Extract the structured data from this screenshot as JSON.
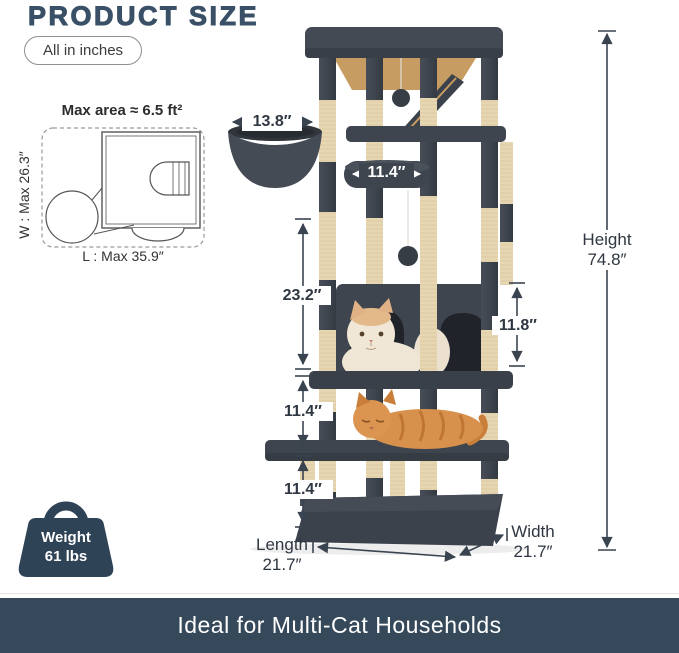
{
  "header": {
    "title": "PRODUCT SIZE",
    "unit_note": "All in inches"
  },
  "footprint": {
    "title": "Max area ≈ 6.5 ft²",
    "width_label": "W : Max 26.3″",
    "length_label": "L : Max 35.9″"
  },
  "dims": {
    "basket_width": "13.8″",
    "perch_width": "11.4″",
    "upper_height": "23.2″",
    "condo_height": "11.8″",
    "mid_height": "11.4″",
    "lower_height": "11.4″",
    "height": {
      "label": "Height",
      "value": "74.8″"
    },
    "length": {
      "label": "Length",
      "value": "21.7″"
    },
    "width": {
      "label": "Width",
      "value": "21.7″"
    }
  },
  "weight": {
    "line1": "Weight",
    "line2": "61 lbs"
  },
  "banner": {
    "text": "Ideal for Multi-Cat Households"
  },
  "colors": {
    "accent_navy": "#3a5066",
    "banner_bg": "#35495a",
    "plush_dark": "#3f454e",
    "sisal_beige": "#ead9b5",
    "wood_tan": "#c79c62",
    "dimension_line": "#3a4450"
  }
}
